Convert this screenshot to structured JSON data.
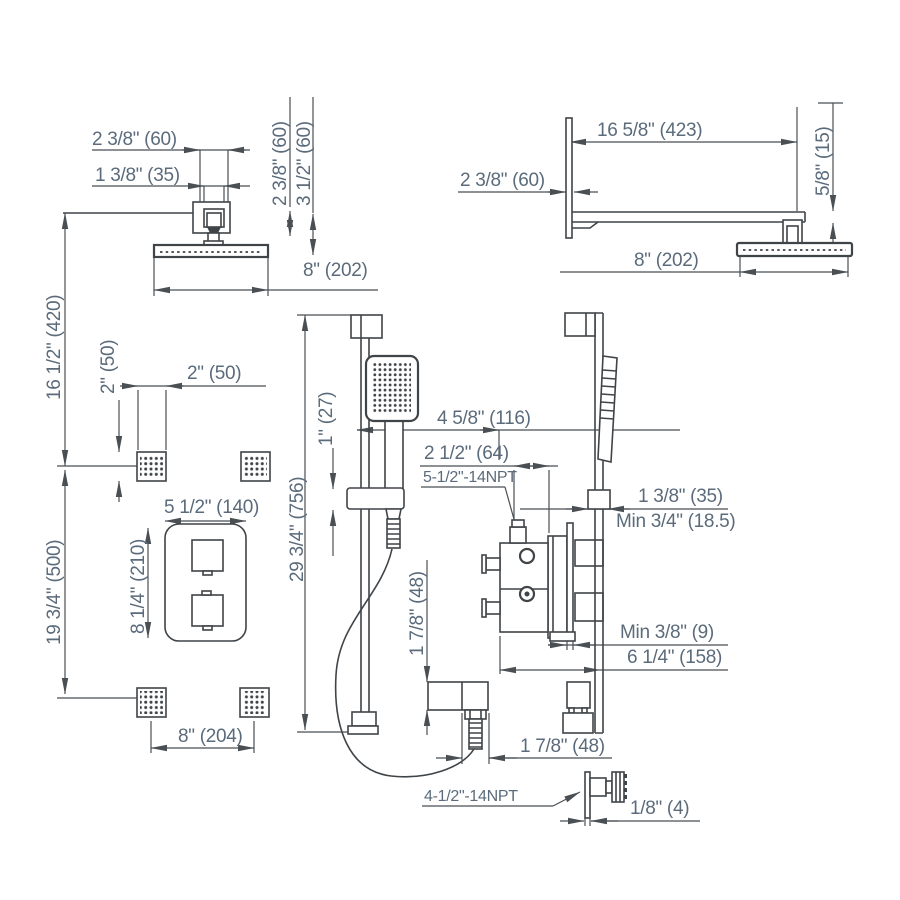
{
  "colors": {
    "line": "#3f4448",
    "dimension_text": "#5b6b7b",
    "background": "#ffffff"
  },
  "views": {
    "ceiling_head_front": {
      "box_width": "2 3/8\" (60)",
      "bracket_width": "1 3/8\" (35)",
      "box_height": "2 3/8\" (60)",
      "ceiling_drop": "3 1/2\" (60)",
      "head_width": "8\" (202)"
    },
    "wall_arm_side": {
      "arm_length": "16 5/8\" (423)",
      "flange_depth": "2 3/8\" (60)",
      "head_drop": "5/8\" (15)",
      "head_width": "8\" (202)"
    },
    "wall_layout": {
      "head_to_jets": "16 1/2\" (420)",
      "jets_to_jets": "19 3/4\" (500)"
    },
    "body_jets": {
      "jet_height": "2\" (50)",
      "jet_width": "2\" (50)",
      "jet_spacing": "8\" (204)"
    },
    "valve_front": {
      "plate_width": "5 1/2\" (140)",
      "plate_height": "8 1/4\" (210)"
    },
    "slide_bar": {
      "bar_length": "29 3/4\" (756)",
      "glide_height": "1\" (27)",
      "handshower_offset": "4 5/8\" (116)",
      "outlet_offset": "2 1/2\" (64)",
      "outlet_thread": "5-1/2\"-14NPT",
      "elbow_height": "1 7/8\" (48)",
      "elbow_width": "1 7/8\" (48)"
    },
    "valve_side": {
      "slider_depth": "1 3/8\" (35)",
      "min_wall_depth": "Min 3/4\" (18.5)",
      "min_plate_depth": "Min 3/8\" (9)",
      "total_depth": "6 1/4\" (158)"
    },
    "body_jet_side": {
      "jet_thread": "4-1/2\"-14NPT",
      "flange_thickness": "1/8\" (4)"
    }
  }
}
